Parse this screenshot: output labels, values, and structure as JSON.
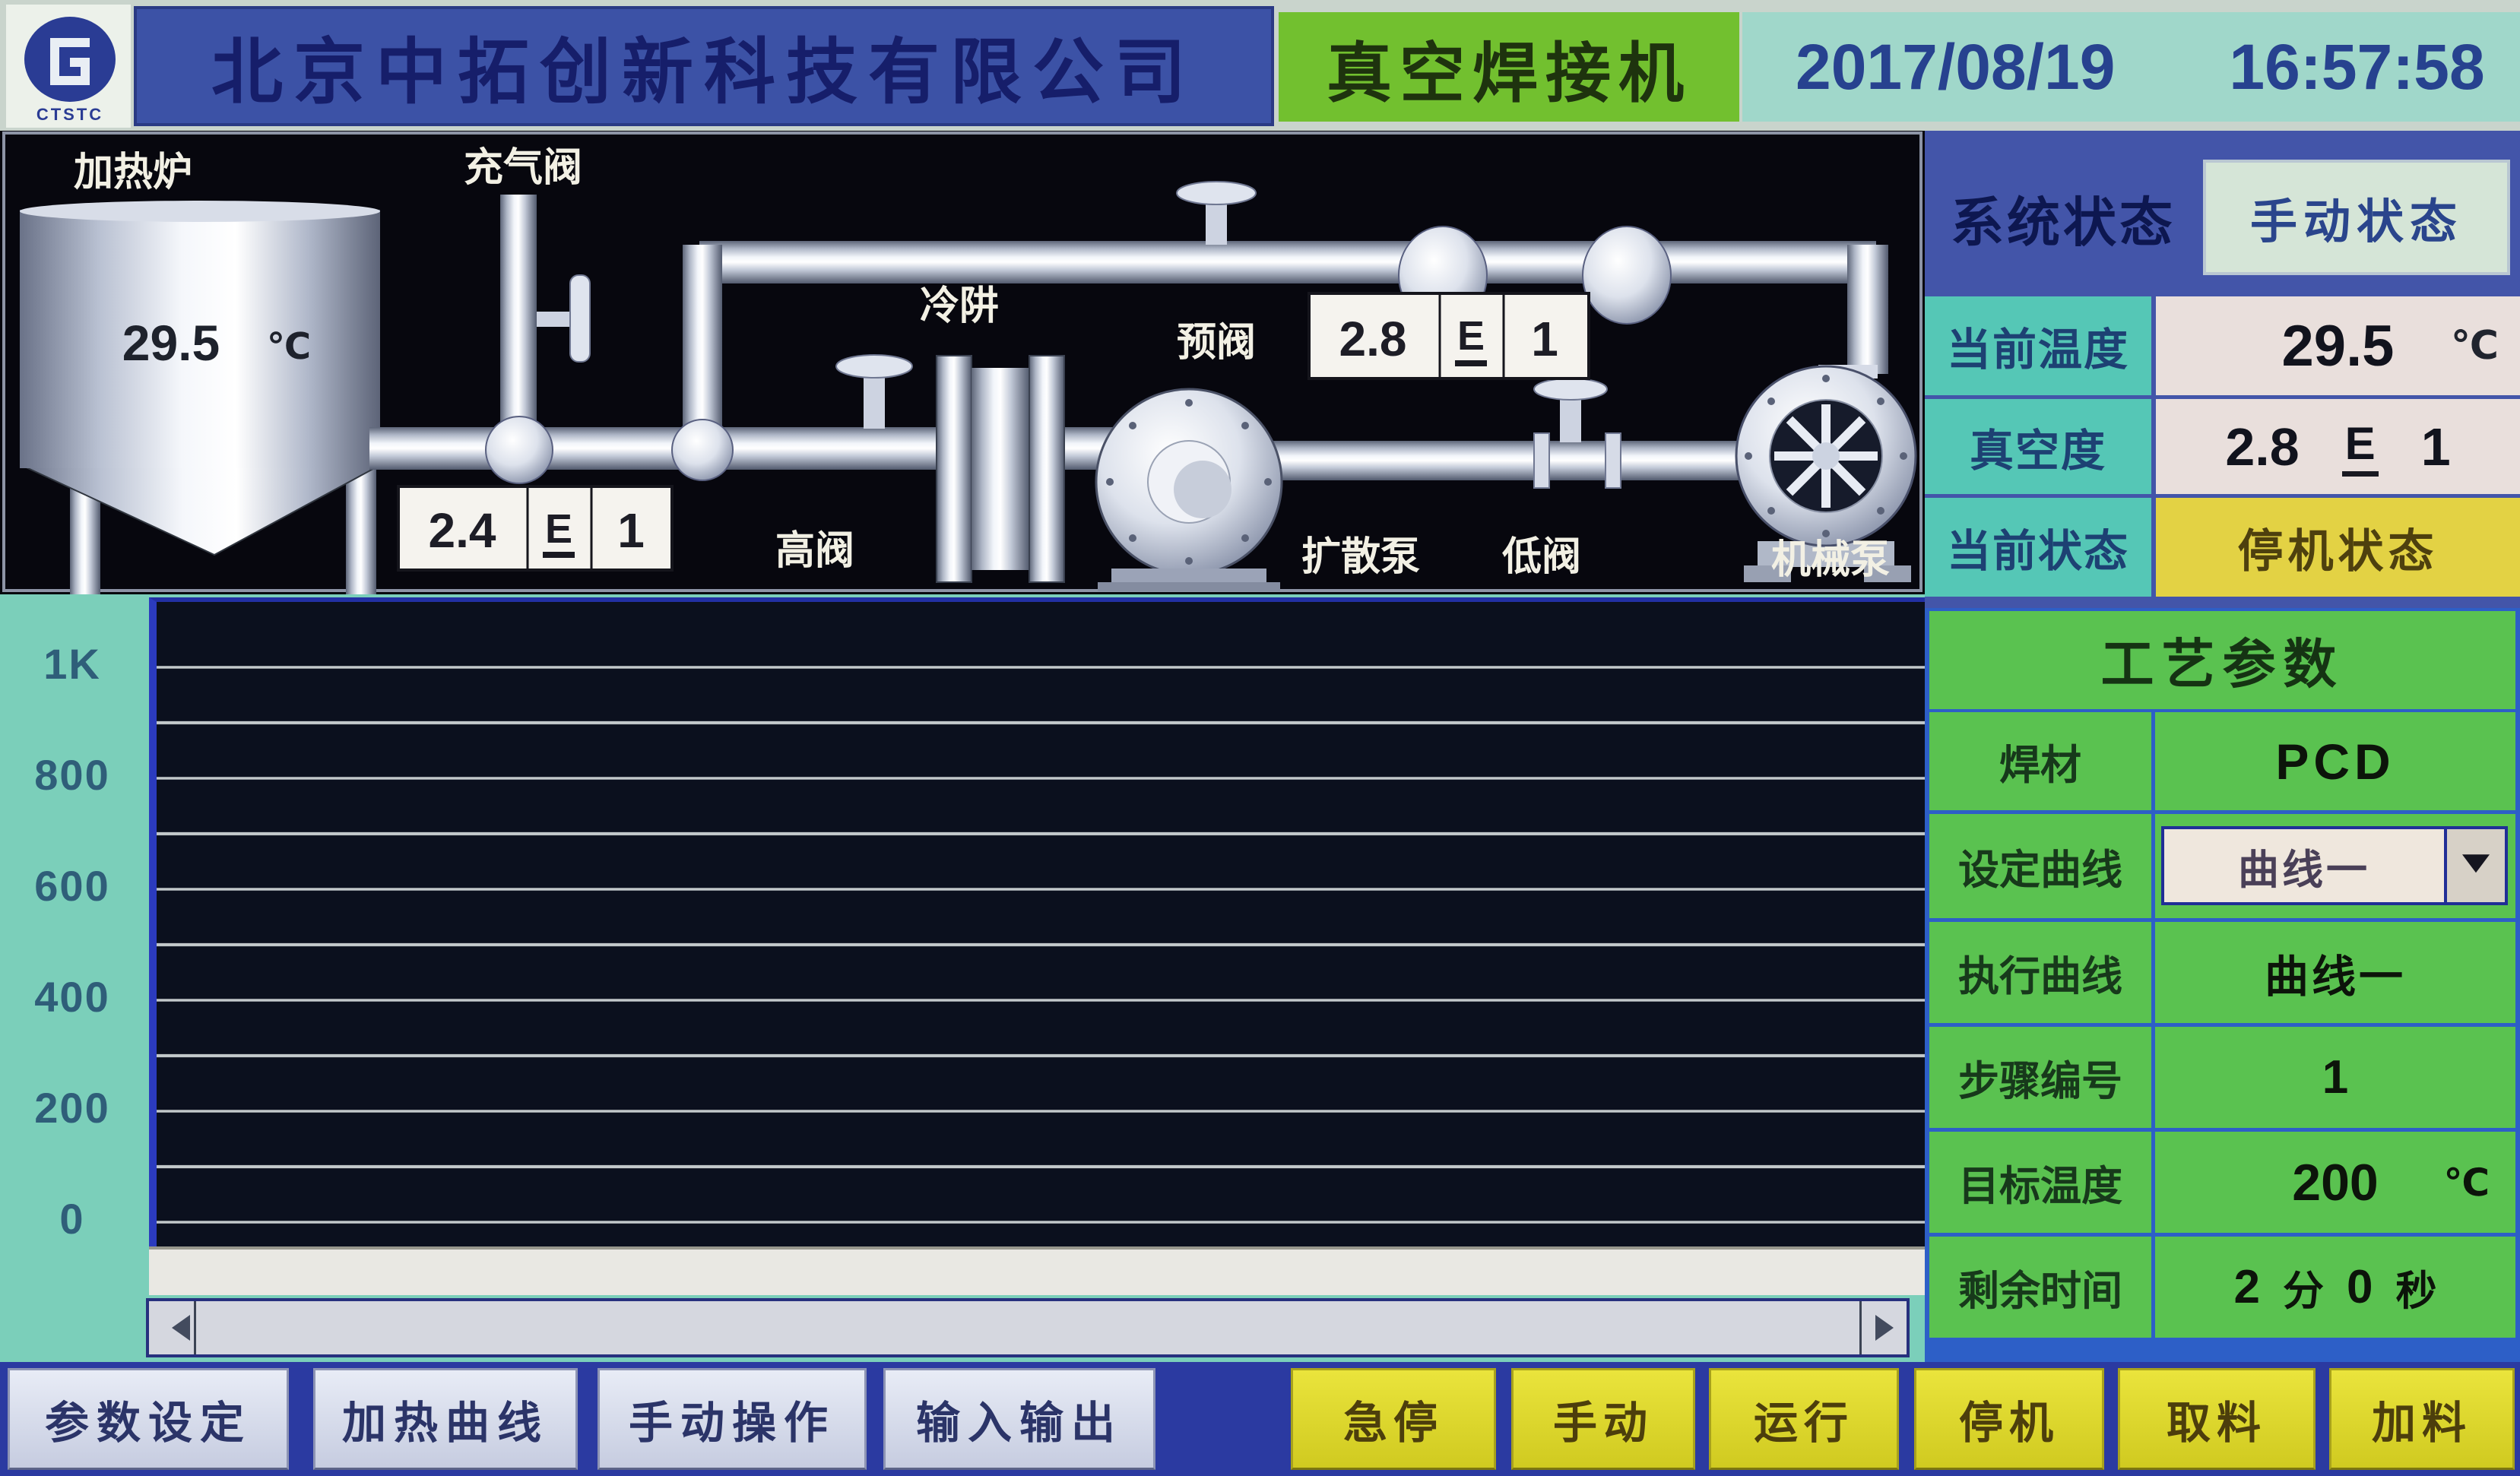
{
  "header": {
    "logo_text": "CTSTC",
    "company": "北京中拓创新科技有限公司",
    "app_title": "真空焊接机",
    "date": "2017/08/19",
    "time": "16:57:58"
  },
  "diagram": {
    "labels": {
      "furnace": "加热炉",
      "charge_valve": "充气阀",
      "cold_trap": "冷阱",
      "pre_valve": "预阀",
      "high_valve": "高阀",
      "diffusion_pump": "扩散泵",
      "low_valve": "低阀",
      "mechanical_pump": "机械泵"
    },
    "furnace_temp": {
      "value": "29.5",
      "unit": "℃"
    },
    "gauge_high_vacuum": {
      "mantissa": "2.4",
      "e": "E",
      "exponent": "1"
    },
    "gauge_pre_vacuum": {
      "mantissa": "2.8",
      "e": "E",
      "exponent": "1"
    }
  },
  "status_panel": {
    "system_status_label": "系统状态",
    "system_status_value": "手动状态",
    "current_temp": {
      "label": "当前温度",
      "value": "29.5",
      "unit": "℃"
    },
    "vacuum": {
      "label": "真空度",
      "mantissa": "2.8",
      "e": "E",
      "exponent": "1"
    },
    "current_state": {
      "label": "当前状态",
      "value": "停机状态"
    }
  },
  "process_panel": {
    "title": "工艺参数",
    "weld_material": {
      "label": "焊材",
      "value": "PCD"
    },
    "set_curve": {
      "label": "设定曲线",
      "value": "曲线一"
    },
    "exec_curve": {
      "label": "执行曲线",
      "value": "曲线一"
    },
    "step_number": {
      "label": "步骤编号",
      "value": "1"
    },
    "target_temp": {
      "label": "目标温度",
      "value": "200",
      "unit": "℃"
    },
    "remaining_time": {
      "label": "剩余时间",
      "minutes": "2",
      "minutes_unit": "分",
      "seconds": "0",
      "seconds_unit": "秒"
    }
  },
  "chart_data": {
    "type": "line",
    "yticks": [
      "1K",
      "800",
      "600",
      "400",
      "200",
      "0"
    ],
    "ylim": [
      0,
      1000
    ],
    "xlabel": "",
    "ylabel": "",
    "grid": true,
    "legend": false,
    "series": []
  },
  "toolbar": {
    "nav_buttons": [
      "参数设定",
      "加热曲线",
      "手动操作",
      "输入输出"
    ],
    "action_buttons": [
      "急停",
      "手动",
      "运行",
      "停机",
      "取料",
      "加料"
    ]
  }
}
